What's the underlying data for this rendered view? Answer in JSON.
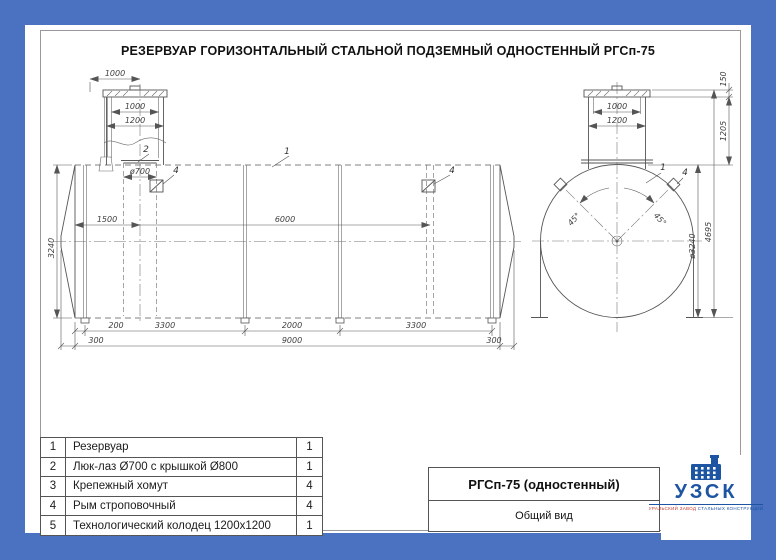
{
  "page": {
    "title": "РЕЗЕРВУАР ГОРИЗОНТАЛЬНЫЙ СТАЛЬНОЙ ПОДЗЕМНЫЙ ОДНОСТЕННЫЙ РГСп-75"
  },
  "colors": {
    "border_blue": "#4a72c1",
    "drawing_line": "#565656",
    "logo_blue": "#1d55a3",
    "logo_red": "#c43b2f"
  },
  "side_view": {
    "dims": {
      "top_1000": "1000",
      "well_inner_1000": "1000",
      "well_outer_1200": "1200",
      "manhole_dia": "ø700",
      "to_manhole_1500": "1500",
      "to_lug_6000": "6000",
      "height_3240": "3240",
      "seg_200": "200",
      "seg_3300a": "3300",
      "seg_2000": "2000",
      "seg_3300b": "3300",
      "end_300l": "300",
      "total_9000": "9000",
      "end_300r": "300"
    },
    "callouts": {
      "tank": "1",
      "manhole": "2",
      "lug_left": "4",
      "lug_right": "4"
    }
  },
  "end_view": {
    "dims": {
      "lid_150": "150",
      "neck_inner_1000": "1000",
      "neck_outer_1200": "1200",
      "neck_1205": "1205",
      "total_4695": "4695",
      "dia_3240": "ø3240",
      "angle_left": "45°",
      "angle_right": "45°"
    },
    "callouts": {
      "tank": "1",
      "lug": "4"
    }
  },
  "parts_table": {
    "rows": [
      {
        "no": "1",
        "name": "Резервуар",
        "qty": "1"
      },
      {
        "no": "2",
        "name": "Люк-лаз Ø700 с крышкой Ø800",
        "qty": "1"
      },
      {
        "no": "3",
        "name": "Крепежный хомут",
        "qty": "4"
      },
      {
        "no": "4",
        "name": "Рым строповочный",
        "qty": "4"
      },
      {
        "no": "5",
        "name": "Технологический колодец 1200x1200",
        "qty": "1"
      }
    ]
  },
  "title_block": {
    "model": "РГСп-75 (одностенный)",
    "view_name": "Общий вид"
  },
  "logo": {
    "abbr": "УЗСК",
    "tagline_left": "УРАЛЬСКИЙ ЗАВОД ",
    "tagline_right": "СТАЛЬНЫХ КОНСТРУКЦИЙ"
  }
}
